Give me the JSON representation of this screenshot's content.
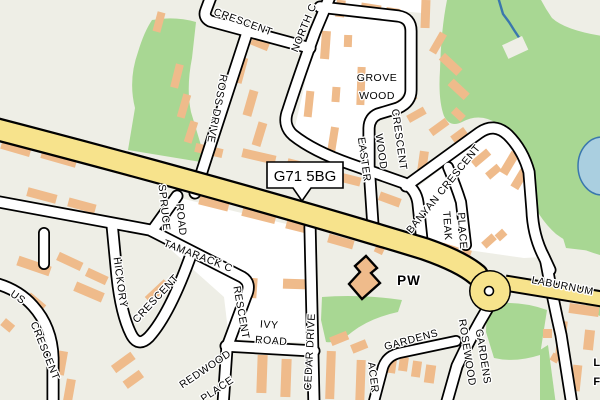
{
  "map": {
    "postcode_label": "G71 5BG",
    "poi": {
      "pw": "PW"
    },
    "streets": {
      "crescent_top": "CRESCENT",
      "north": "NORTH C",
      "ross_drive": "ROSS DRIVE",
      "grove_wood_1": "GROVE",
      "grove_wood_2": "WOOD",
      "easter_1": "EASTER",
      "easter_2": "WOOD",
      "easter_3": "CRESCENT",
      "banyan": "BANYAN CRESCENT",
      "teak_1": "TEAK",
      "teak_2": "PLACE",
      "spruce_1": "SPRUCE",
      "spruce_2": "ROAD",
      "tamarack_1": "TAMARACK C",
      "tamarack_2": "RESCENT",
      "hickory_1": "HICKORY",
      "hickory_2": "CRESCENT",
      "ivy_1": "IVY",
      "ivy_2": "ROAD",
      "cedar": "CEDAR DRIVE",
      "redwood_1": "REDWOOD",
      "redwood_2": "PLACE",
      "acer_1": "GARDENS",
      "acer_2": "ACER",
      "us_crescent_1": "US",
      "us_crescent_2": "CRESCENT",
      "rosewood_1": "ROSEWOOD",
      "rosewood_2": "GARDENS",
      "laburnum": "LABURNUM",
      "partial_1": "L",
      "partial_2": "F"
    },
    "colors": {
      "background": "#eeeee6",
      "road_fill": "#ffffff",
      "road_casing": "#000000",
      "primary_road": "#f7e38c",
      "green": "#a8d793",
      "building": "#efbb8b",
      "water_fill": "#aacfe0",
      "water_line": "#3a77ad",
      "label": "#000000"
    }
  }
}
